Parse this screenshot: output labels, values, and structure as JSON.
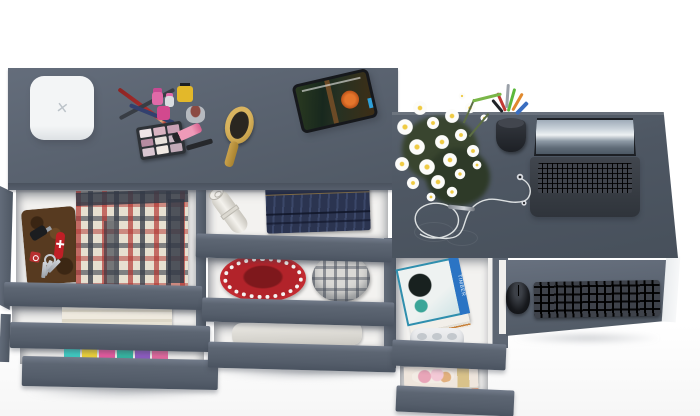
{
  "scene": {
    "description": "Top-down 3D product render of a matte gray vanity dresser, a middle drawer unit and an attached computer desk, all with drawers pulled open to show contents, on a white background",
    "background_color": "#ffffff"
  },
  "palette": {
    "dresser_top_gray": "#5a6370",
    "desk_top_gray": "#4e5763",
    "drawer_front_gray": "#5d6673",
    "drawer_interior_white": "#f3f2f0",
    "basket_red": "#b2232a",
    "denim_blue": "#2b3450",
    "book_teal": "#2f8fae",
    "book_spine_blue": "#2b74c4",
    "brush_wood": "#c9a14b",
    "flower_center_yellow": "#efcb44",
    "clothes_colors": [
      "#3fc8c0",
      "#e9cf3a",
      "#e25a9e",
      "#35b3a0",
      "#8d5cc0",
      "#e2699e"
    ]
  },
  "labels": {
    "charger_mark": "✕",
    "book_spine": "TIMBER"
  },
  "vanity": {
    "top_items": [
      "white square box with x mark",
      "red pencil",
      "dark pencil",
      "navy eyeliner pencil",
      "pink nail polish",
      "small pink polish",
      "clear polish bottle",
      "yellow nail polish",
      "silver cosmetic jar",
      "eyeshadow palette 3x3",
      "pink lip gloss tube",
      "mascara",
      "wooden hair brush",
      "tablet playing animated movie"
    ],
    "drawer1_items": [
      "brown leather wallet",
      "car key",
      "red swiss army knife",
      "red key fob",
      "keys on ring",
      "folded red-gray plaid shirts"
    ],
    "drawer2_items": [
      "folded beige towel"
    ],
    "drawer3_items": [
      "stack of colorful folded clothes"
    ]
  },
  "middle_unit": {
    "drawer1_items": [
      "rolled paper poster",
      "folded dark jeans"
    ],
    "drawer2_items": [
      "red woven round basket",
      "gray plaid fabric roll"
    ],
    "drawer3_items": [
      "white folded bundle"
    ]
  },
  "desk": {
    "top_items": [
      "bouquet of white daisies",
      "black pen cup with pens and markers",
      "open laptop with mountain wallpaper",
      "white earbuds with cable",
      "silver stylus pen"
    ],
    "book_drawer_items": [
      "teal book with spine text",
      "stack of pages",
      "white game controller"
    ],
    "tray_items": [
      "black wireless keyboard",
      "black mouse"
    ],
    "lower_drawer_items": [
      "magazines with flower photo cover"
    ]
  }
}
